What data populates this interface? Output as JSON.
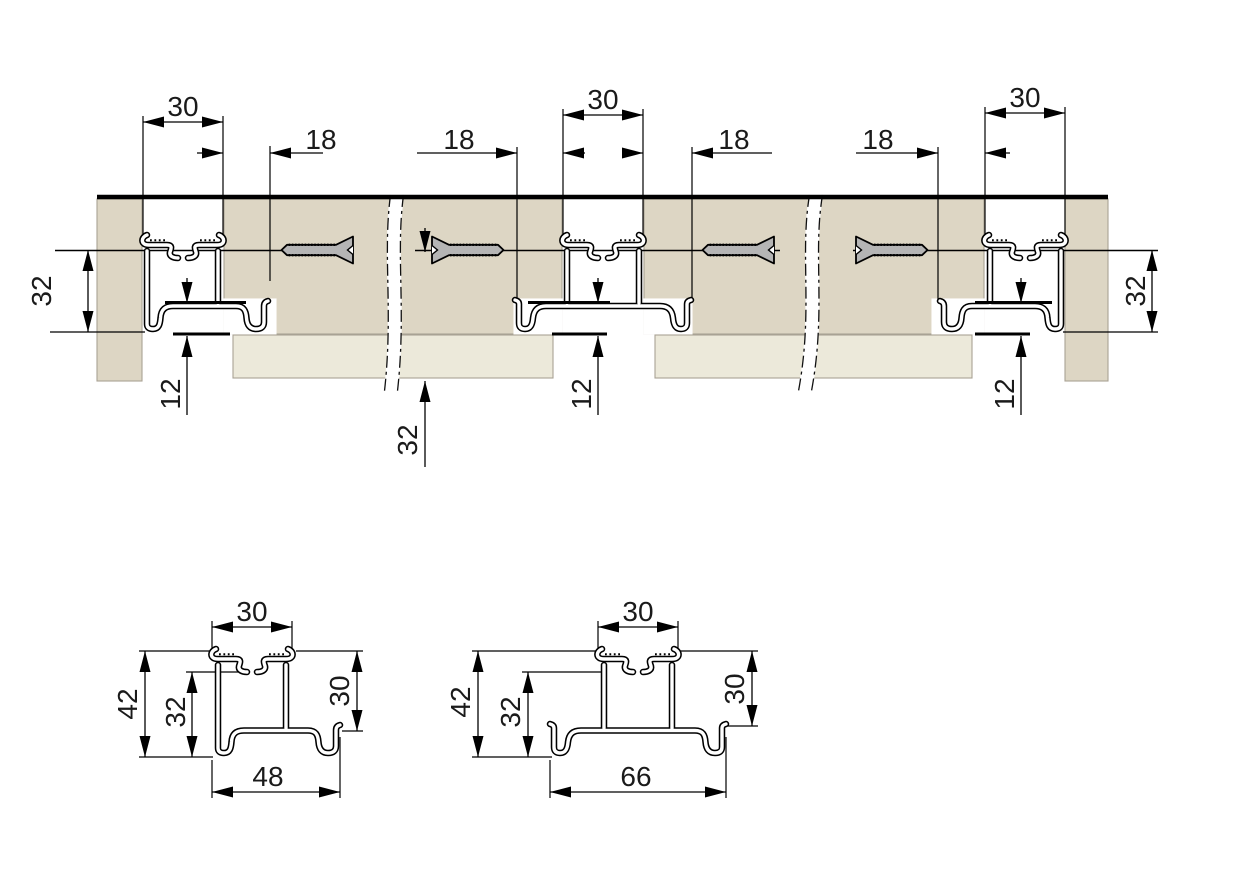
{
  "colors": {
    "panel_tan": "#ddd6c4",
    "panel_cream": "#ece9da",
    "panel_edge": "#a9a294",
    "screw_gray": "#b5b5b5",
    "line": "#000000",
    "background": "#ffffff"
  },
  "top_view": {
    "groove_width_labels": [
      "30",
      "30",
      "30"
    ],
    "screw_offset_labels": [
      "18",
      "18",
      "18",
      "18"
    ],
    "profile_height_left": "32",
    "profile_height_right": "32",
    "screw_line_depth": "32",
    "bottom_inset_labels": [
      "12",
      "12",
      "12"
    ]
  },
  "detail_left": {
    "groove_width": "30",
    "total_height": "42",
    "channel_height": "32",
    "side_height": "30",
    "base_width": "48"
  },
  "detail_right": {
    "groove_width": "30",
    "total_height": "42",
    "channel_height": "32",
    "side_height": "30",
    "base_width": "66"
  }
}
